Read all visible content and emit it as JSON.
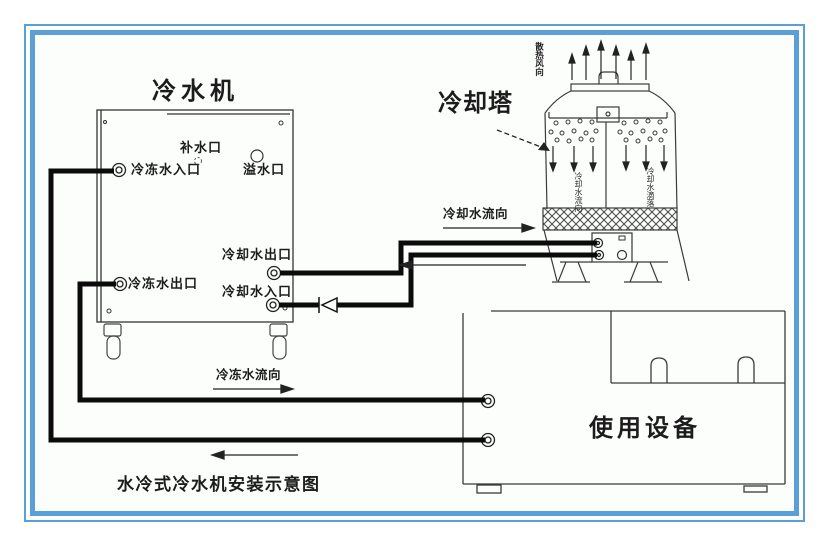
{
  "frame": {
    "border_color": "#5b9fd9"
  },
  "titles": {
    "chiller": "冷水机",
    "cooling_tower": "冷却塔",
    "equipment": "使用设备",
    "caption": "水冷式冷水机安装示意图"
  },
  "chiller_ports": {
    "makeup": "补水口",
    "chilled_in": "冷冻水入口",
    "overflow": "溢水口",
    "cooling_out": "冷却水出口",
    "chilled_out": "冷冻水出口",
    "cooling_in": "冷却水入口"
  },
  "flow_labels": {
    "cooling": "冷却水流向",
    "chilled": "冷冻水流向"
  },
  "tower_labels": {
    "exhaust_air": "散热风向",
    "fall_left": "冷却水流向",
    "fall_right": "冷却水滴落"
  }
}
